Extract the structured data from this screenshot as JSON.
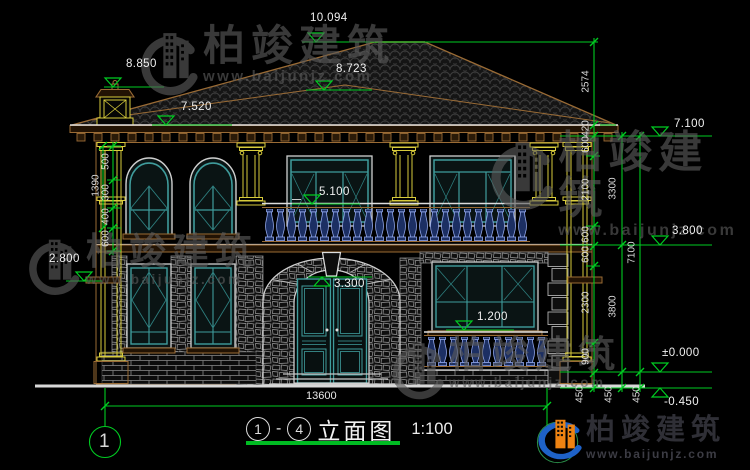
{
  "drawing": {
    "levels": {
      "ridge": "10.094",
      "chimney_top": "8.850",
      "back_ridge": "8.723",
      "eave": "7.520",
      "eave_right": "7.100",
      "balcony_rail": "5.100",
      "second_floor": "3.800",
      "entry_arch": "3.300",
      "side_ledge": "2.800",
      "window_sill": "1.200",
      "first_floor": "±0.000",
      "grade": "-0.450"
    },
    "dimensions": {
      "total_width": "13600",
      "right_chain_inner": [
        "2574",
        "420",
        "600",
        "2100",
        "600",
        "600",
        "2300",
        "900",
        "450"
      ],
      "right_chain_mid": [
        "3300",
        "3800",
        "450"
      ],
      "right_chain_outer": [
        "7100",
        "450"
      ],
      "left_chain": [
        "500",
        "300",
        "400",
        "600"
      ],
      "left_chain_outer": "1390"
    },
    "axis": {
      "bubble_label": "1"
    },
    "title": {
      "axis_from": "1",
      "separator": "-",
      "axis_to": "4",
      "name": "立面图",
      "scale": "1:100"
    }
  },
  "watermark": {
    "brand": "柏竣建筑",
    "url": "www.baijunjz.com"
  },
  "logo": {
    "brand": "柏竣建筑",
    "url": "www.baijunjz.com"
  },
  "colors": {
    "dimension_green": "#00cc22",
    "linework_tan": "#9a6b35",
    "accent_yellow": "#d8cc3c",
    "window_teal": "#3f9c9c",
    "baluster_blue": "#8fa4e8",
    "logo_blue": "#1e62c8",
    "logo_orange": "#ee8312"
  }
}
